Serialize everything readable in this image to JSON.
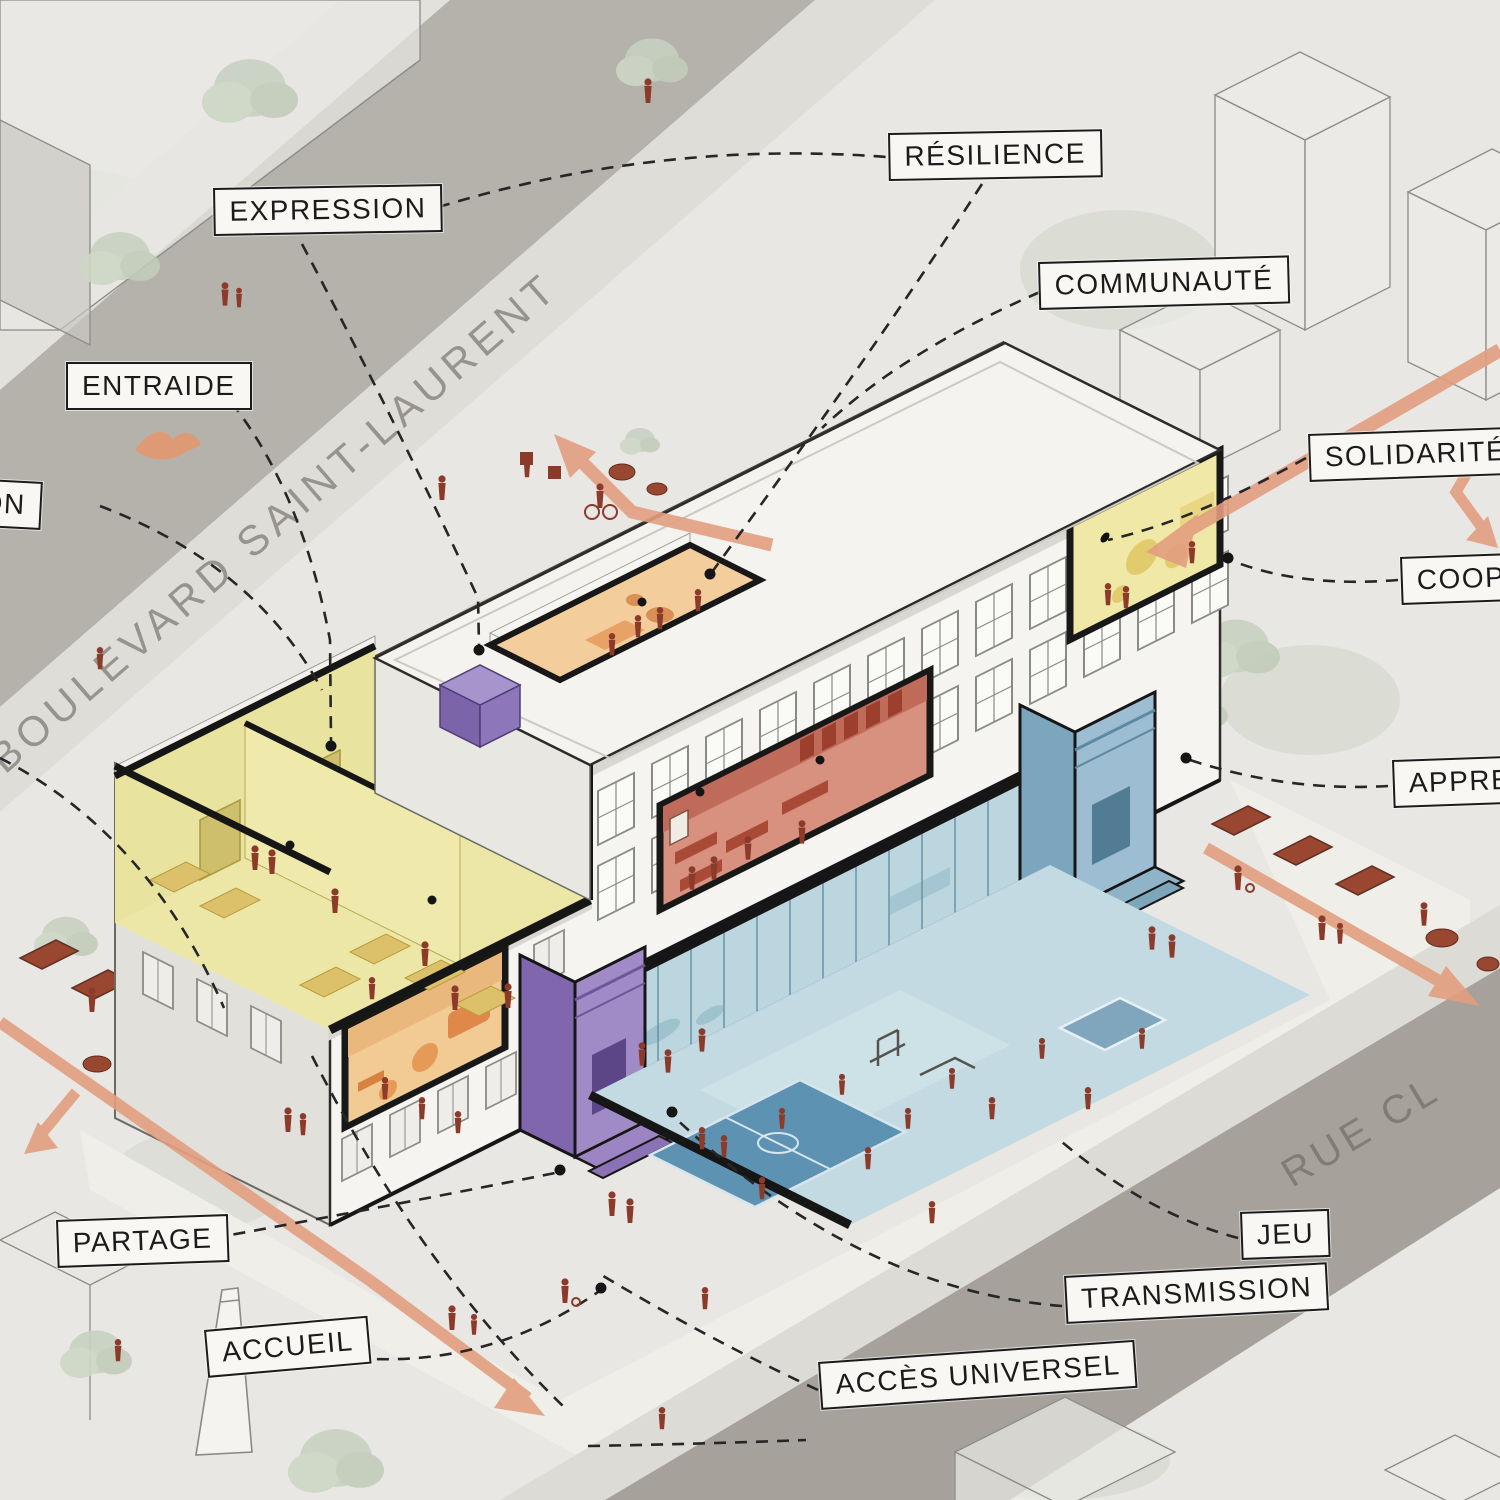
{
  "diagram": {
    "concept_labels": [
      {
        "id": "expression",
        "text": "EXPRESSION"
      },
      {
        "id": "entraide",
        "text": "ENTRAIDE"
      },
      {
        "id": "on-partial",
        "text": "ON"
      },
      {
        "id": "resilience",
        "text": "RÉSILIENCE"
      },
      {
        "id": "communaute",
        "text": "COMMUNAUTÉ"
      },
      {
        "id": "solidarite",
        "text": "SOLIDARITÉ"
      },
      {
        "id": "coop-partial",
        "text": "COOP"
      },
      {
        "id": "appre-partial",
        "text": "APPRE"
      },
      {
        "id": "partage",
        "text": "PARTAGE"
      },
      {
        "id": "accueil",
        "text": "ACCUEIL"
      },
      {
        "id": "jeu",
        "text": "JEU"
      },
      {
        "id": "transmission",
        "text": "TRANSMISSION"
      },
      {
        "id": "acces-universel",
        "text": "ACCÈS UNIVERSEL"
      }
    ],
    "streets": {
      "boulevard": "BOULEVARD SAINT-LAURENT",
      "rue": "RUE CL"
    },
    "colors": {
      "paper": "#e8e7e3",
      "street": "#b5b2ac",
      "street_dark": "#a6a29b",
      "label_ink": "#1b1b1b",
      "label_bg": "#f8f7f4",
      "arrow": "#e29e7f",
      "figure": "#8c3b2b",
      "room_yellow": "#ece7a6",
      "room_orange": "#f2ca94",
      "room_red": "#d8917f",
      "zone_blue": "#bcd6e0",
      "entrance_purple": "#a18bc7",
      "entrance_blue": "#9dbed2"
    }
  }
}
